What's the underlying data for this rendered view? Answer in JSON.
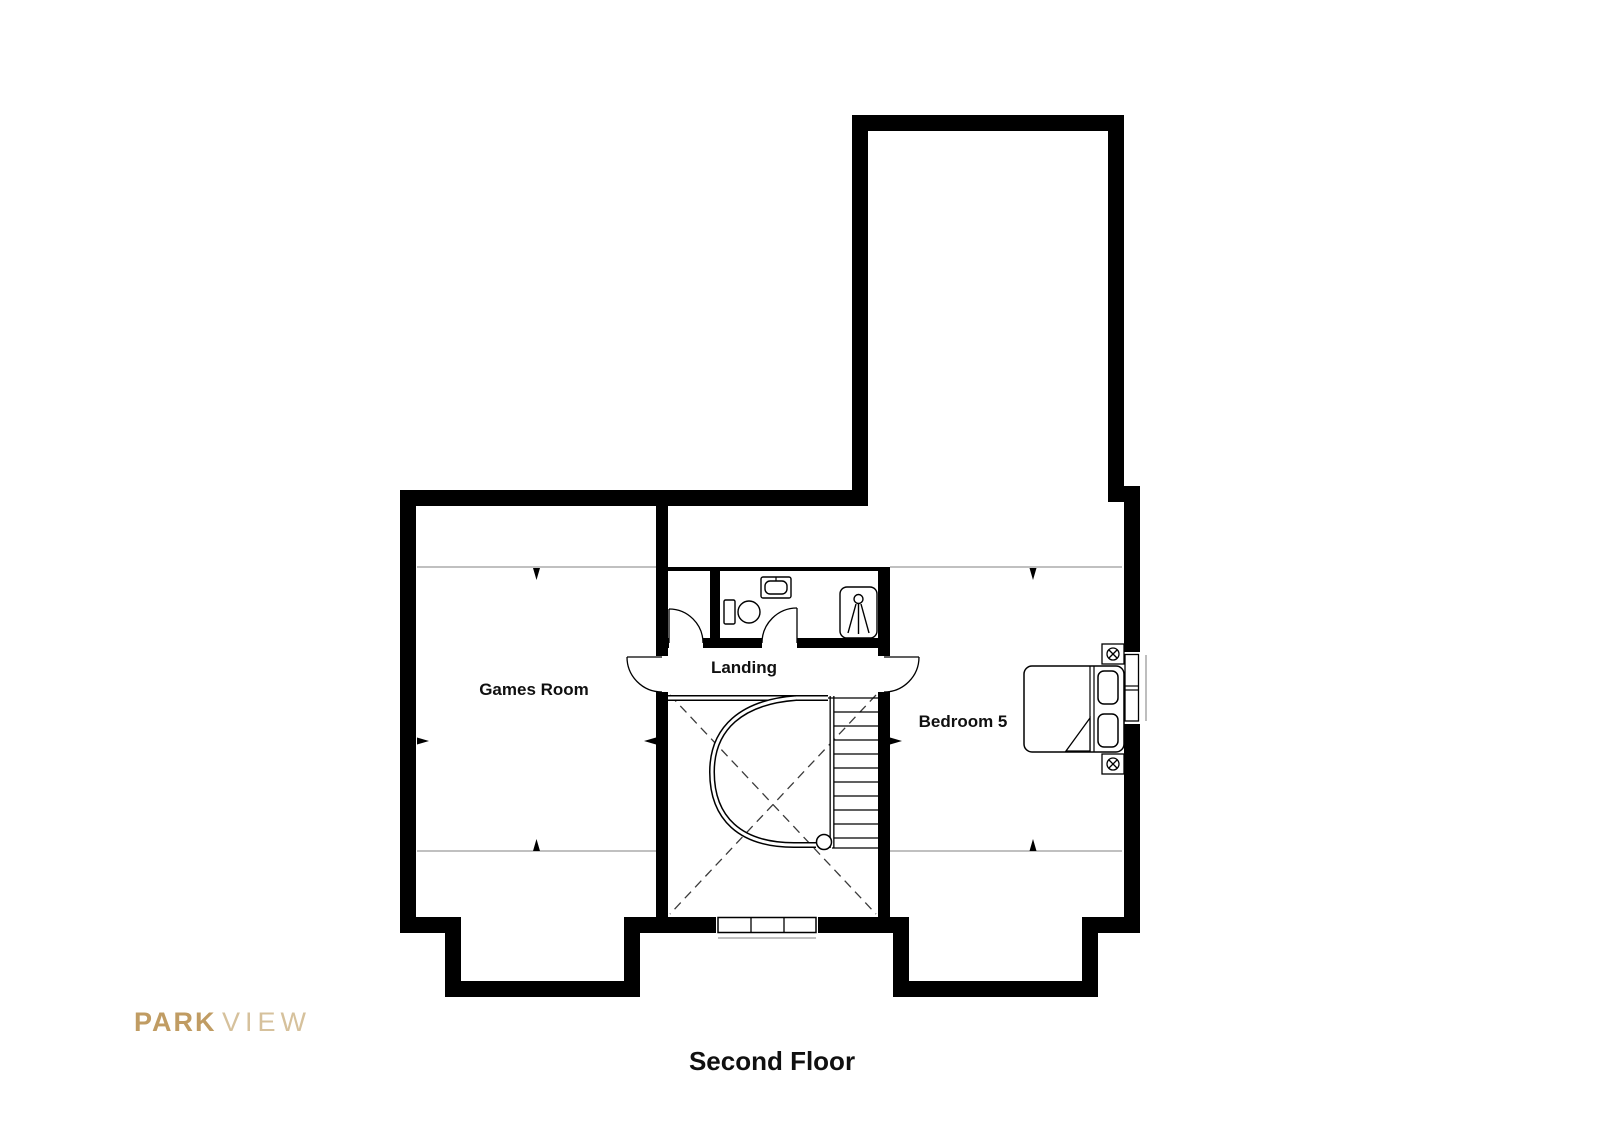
{
  "page": {
    "background": "#ffffff"
  },
  "title": {
    "text": "Second Floor"
  },
  "logo": {
    "park": "PARK",
    "view": "VIEW",
    "park_color": "#c09c63",
    "view_color": "#d6c19c"
  },
  "rooms": {
    "games_room": {
      "label": "Games Room"
    },
    "landing": {
      "label": "Landing"
    },
    "bedroom5": {
      "label": "Bedroom 5"
    }
  },
  "palette": {
    "wall": "#000000",
    "line": "#000000",
    "eaves_line": "#9b9b9b",
    "floor": "#ffffff"
  },
  "icons": [
    "toilet-icon",
    "washbasin-icon",
    "shower-icon",
    "bed-icon",
    "pillow-icon",
    "bedside-lamp-icon",
    "curved-staircase-icon",
    "window-icon",
    "door-icon",
    "void-cross-icon",
    "headroom-arrow-icon"
  ]
}
